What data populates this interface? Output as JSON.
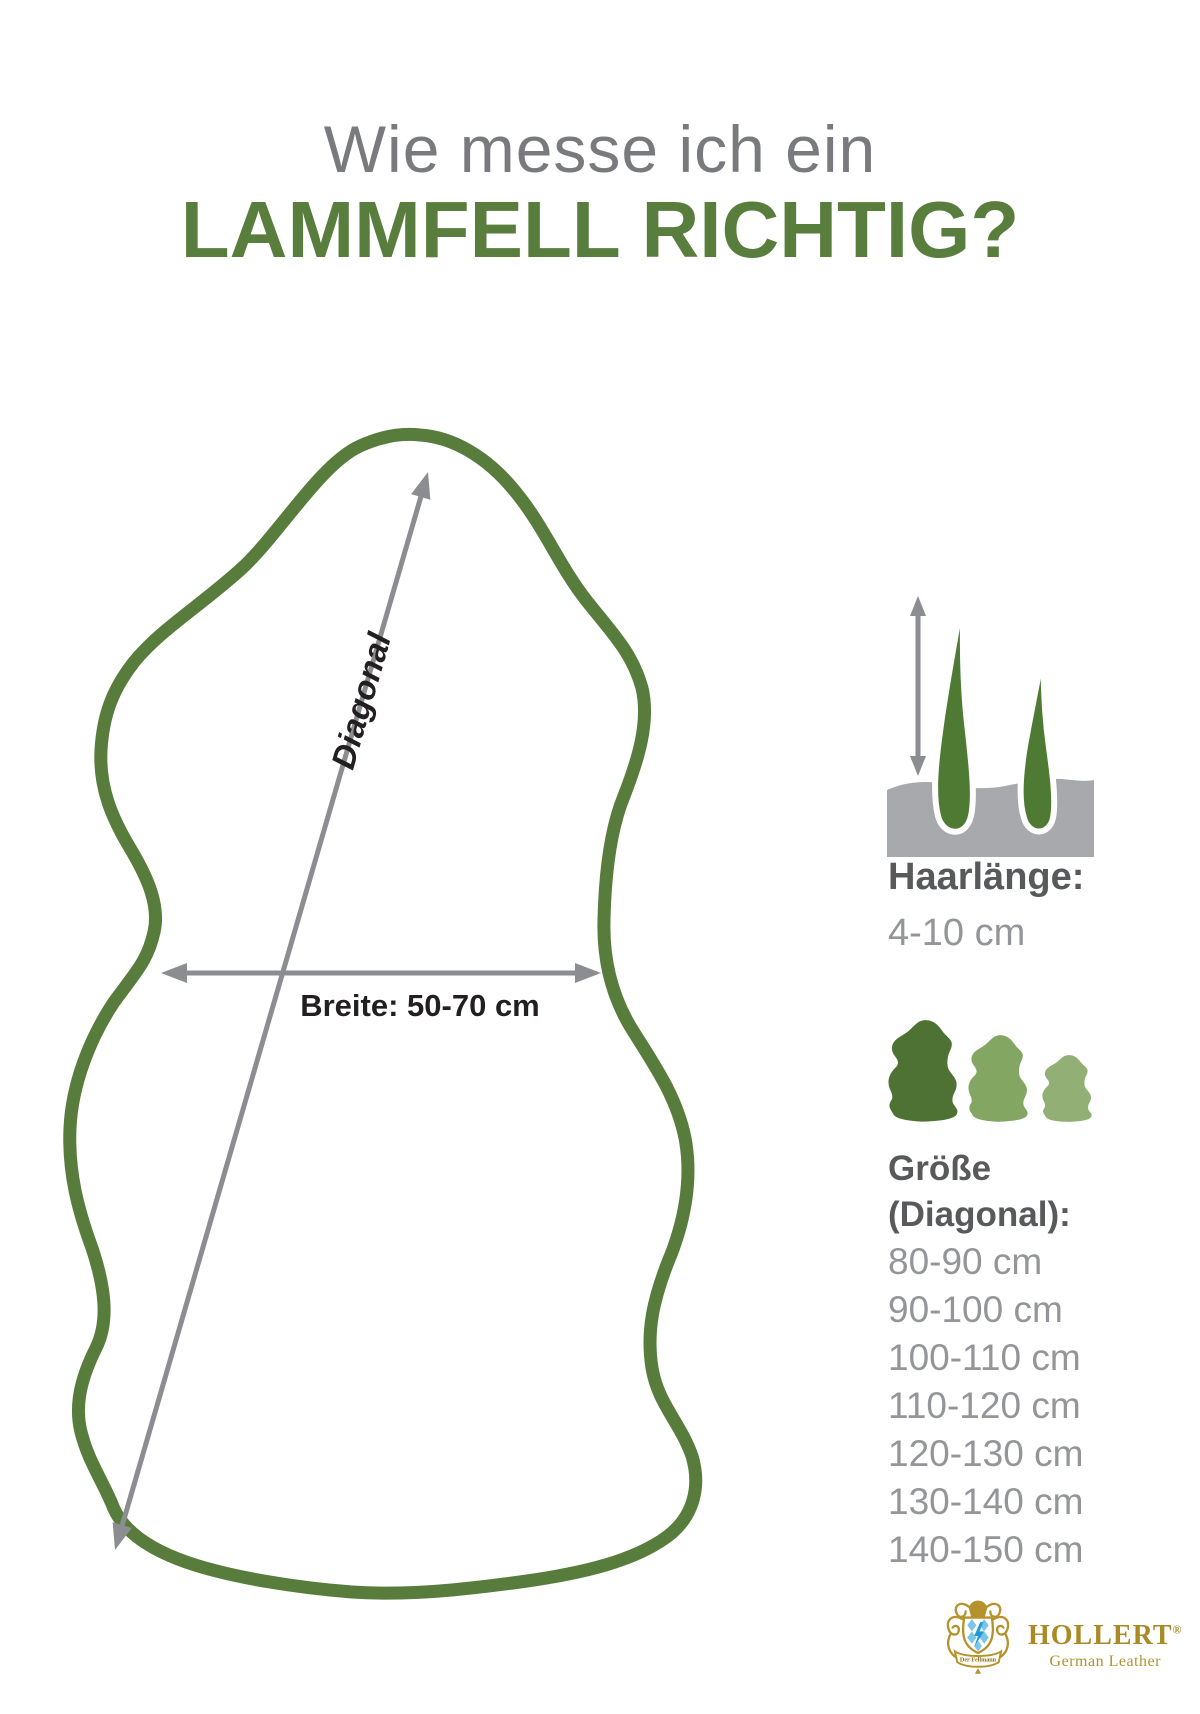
{
  "title": {
    "line1": "Wie messe ich ein",
    "line2": "LAMMFELL RICHTIG?"
  },
  "diagram": {
    "diagonal_label": "Diagonal",
    "width_label": "Breite: 50-70 cm"
  },
  "hair_length": {
    "heading": "Haarlänge:",
    "value": "4-10 cm"
  },
  "size": {
    "heading_line1": "Größe",
    "heading_line2": "(Diagonal):",
    "options": [
      "80-90 cm",
      "90-100 cm",
      "100-110 cm",
      "110-120 cm",
      "120-130 cm",
      "130-140 cm",
      "140-150 cm"
    ]
  },
  "logo": {
    "brand": "HOLLERT",
    "registered_mark": "®",
    "tagline": "German Leather",
    "crest_banner": "Der Fellmann"
  },
  "colors": {
    "green_outline": "#587c3b",
    "green_title": "#587d3c",
    "green_dark": "#4d7233",
    "green_mid": "#83a662",
    "green_light": "#92b075",
    "hair_green": "#4f7a33",
    "title_gray": "#797a7d",
    "heading_gray": "#58595b",
    "body_gray": "#939598",
    "arrow_gray": "#8b8d90",
    "skin_block_gray": "#a7a9ac",
    "label_black": "#231f20",
    "logo_gold": "#a98a25",
    "crest_blue": "#7cc4e8",
    "bolt_blue": "#1f9cd8"
  }
}
